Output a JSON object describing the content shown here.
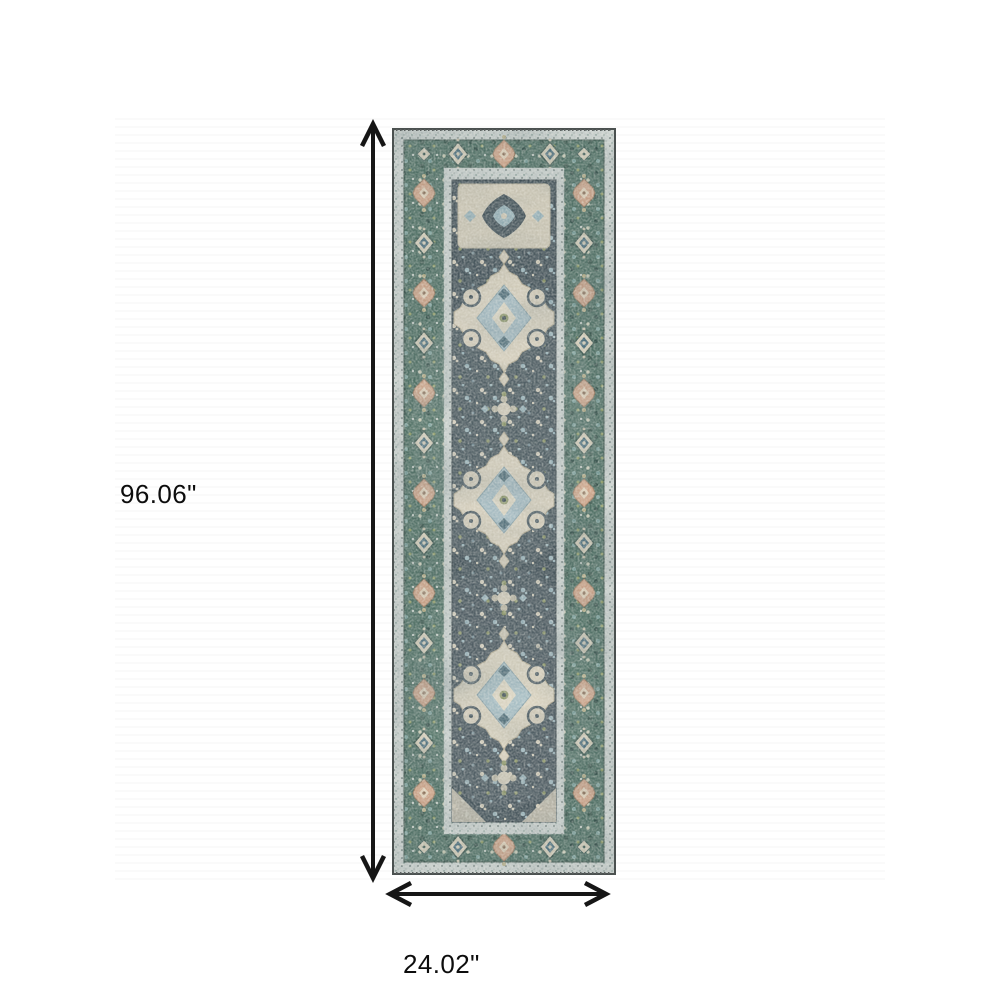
{
  "diagram": {
    "title": "Runner rug dimension diagram",
    "height_label": "96.06\"",
    "width_label": "24.02\"",
    "icons": {
      "vertical_arrow": "double-headed-vertical-arrow",
      "horizontal_arrow": "double-headed-horizontal-arrow"
    },
    "colors": {
      "background": "#ffffff",
      "arrow": "#161616",
      "label_text": "#0d0d0d",
      "rug_border_teal": "#507165",
      "rug_field_slate": "#45535a",
      "rug_cream": "#d8d0bc",
      "rug_light_guard": "#cdd4d1",
      "rug_accent_peach": "#d2a78b",
      "rug_accent_blue": "#9bb5bc",
      "rug_accent_olive": "#8e9766"
    }
  }
}
